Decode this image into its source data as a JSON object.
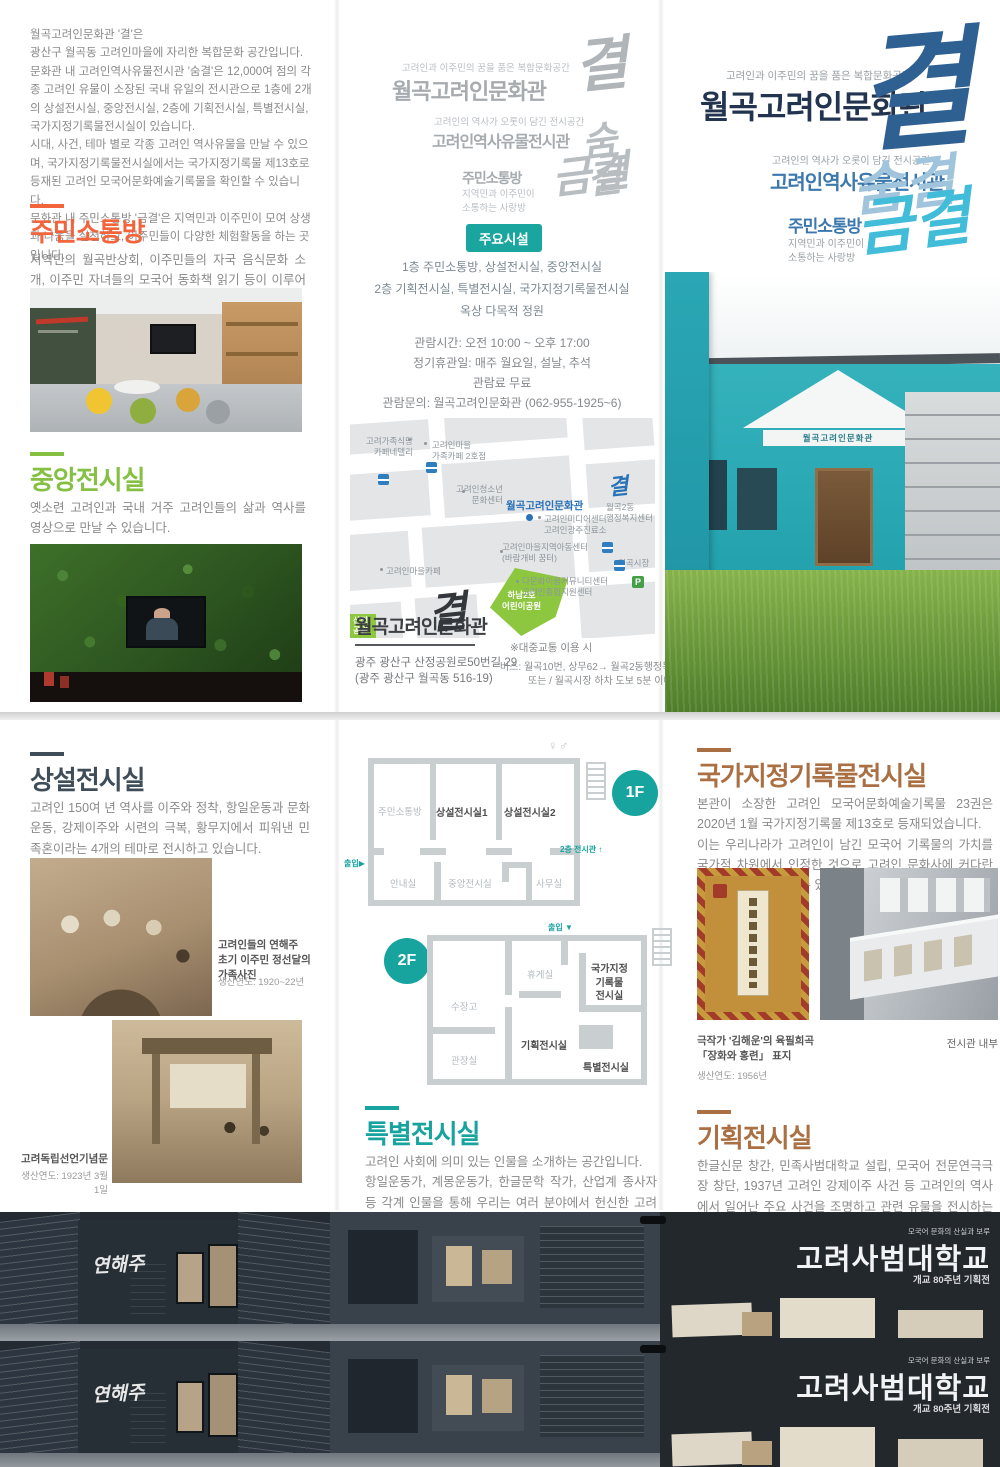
{
  "cover": {
    "tagline": "고려인과 이주민의 꿈을 품은 복합문화공간",
    "title": "월곡고려인문화관",
    "script_main": "결",
    "exhibit_tagline": "고려인의 역사가 오롯이 담긴 전시공간",
    "exhibit_title": "고려인역사유물전시관",
    "script_exhibit": "숨결",
    "lounge_title": "주민소통방",
    "script_lounge": "금결",
    "lounge_sub": "지역민과 이주민이\n소통하는 사랑방",
    "building_sign": "월곡고려인문화관"
  },
  "intro": {
    "text": "월곡고려인문화관 '결'은\n광산구 월곡동 고려인마을에 자리한 복합문화 공간입니다.\n문화관 내 고려인역사유물전시관 '숨결'은 12,000여 점의 각종 고려인 유물이 소장된 국내 유일의 전시관으로 1층에 2개의 상설전시실, 중앙전시실, 2층에 기획전시실, 특별전시실, 국가지정기록물전시실이 있습니다.\n시대, 사건, 테마 별로 각종 고려인 역사유물을 만날 수 있으며, 국가지정기록물전시실에서는 국가지정기록물 제13호로 등재된 고려인 모국어문화예술기록물을 확인할 수 있습니다.\n문화관 내 주민소통방 '금결'은 지역민과 이주민이 모여 상생과 나눔을 실천하고, 이주민들이 다양한 체험활동을 하는 곳 입니다."
  },
  "sections": {
    "communication": {
      "title": "주민소통방",
      "body": "지역민의 월곡반상회, 이주민들의 자국 음식문화 소개, 이주민 자녀들의 모국어 동화책 읽기 등이 이루어집니다."
    },
    "central": {
      "title": "중앙전시실",
      "body": "옛소련 고려인과 국내 거주 고려인들의 삶과 역사를 영상으로 만날 수 있습니다."
    },
    "permanent": {
      "title": "상설전시실",
      "body": "고려인 150여 년 역사를 이주와 정착, 항일운동과 문화운동, 강제이주와 시련의 극복, 황무지에서 피워낸 민족혼이라는 4개의 테마로 전시하고 있습니다."
    },
    "special": {
      "title": "특별전시실",
      "body": "고려인 사회에 의미 있는 인물을 소개하는 공간입니다.\n항일운동가, 계몽운동가, 한글문학 작가, 산업계 종사자 등 각계 인물을 통해 우리는 여러 분야에서 헌신한 고려인들의 숨결을 느낄 수 있습니다."
    },
    "records": {
      "title": "국가지정기록물전시실",
      "body": "본관이 소장한 고려인 모국어문화예술기록물 23권은 2020년 1월 국가지정기록물 제13호로 등재되었습니다.\n이는 우리나라가 고려인이 남긴 모국어 기록물의 가치를 국가적 차원에서 인정한 것으로 고려인 문화사에 커다란 의의를 지닌다고 할 수 있습니다."
    },
    "planning": {
      "title": "기획전시실",
      "body": "한글신문 창간, 민족사범대학교 설립, 모국어 전문연극극장 창단, 1937년 고려인 강제이주 사건 등 고려인의 역사에서 일어난 주요 사건을 조명하고 관련 유물을 전시하는 공간입니다."
    }
  },
  "facilities": {
    "badge": "주요시설",
    "floor1": "1층 주민소통방, 상설전시실, 중앙전시실",
    "floor2": "2층 기획전시실, 특별전시실, 국가지정기록물전시실",
    "roof": "옥상 다목적 정원"
  },
  "visit": {
    "hours": "관람시간: 오전 10:00 ~ 오후 17:00",
    "closed": "정기휴관일: 매주 월요일, 설날, 추석",
    "fee": "관람료 무료",
    "contact": "관람문의: 월곡고려인문화관 (062-955-1925~6)"
  },
  "location": {
    "name": "월곡고려인문화관",
    "script": "결",
    "road": "광주 광산구 산정공원로50번길 29",
    "lot": "(광주 광산구 월곡동 516-19)",
    "transit_note": "※대중교통 이용 시",
    "bus1": "버스: 월곡10번, 상무62→ 월곡2동행정복지센터",
    "bus2": "또는 / 월곡시장 하차 도보 5분 이내"
  },
  "map": {
    "main": {
      "label": "월곡고려인문화관",
      "script": "결"
    },
    "labels": [
      {
        "text": "고려가족식당\n카페네델리"
      },
      {
        "text": "고려인마을\n가족카페 2호점"
      },
      {
        "text": "고려인청소년\n문화센터"
      },
      {
        "text": "고려인미디어센터\n고려인광주진료소"
      },
      {
        "text": "월곡2동\n행정복지센터"
      },
      {
        "text": "고려인마을지역아동센터\n(바람개비 꿈터)"
      },
      {
        "text": "월곡시장"
      },
      {
        "text": "다문화이음커뮤니티센터\n고려인종합지원센터"
      },
      {
        "text": "고려인마을카페"
      }
    ],
    "parks": [
      {
        "name": "하남2호\n어린이공원"
      },
      {
        "name": "산정\n공원"
      }
    ],
    "parking": "P"
  },
  "floorplan": {
    "icons": {
      "restroom": "♀♂",
      "arrow_right": "▶",
      "arrow_up": "↑",
      "arrow_down": "▼"
    },
    "f1": {
      "badge": "1F",
      "rooms": [
        "주민소통방",
        "상설전시실1",
        "상설전시실2",
        "안내실",
        "중앙전시실",
        "사무실"
      ],
      "entry": "출입",
      "to_upper": "2층 전시관"
    },
    "f2": {
      "badge": "2F",
      "rooms": [
        "수장고",
        "휴게실",
        "국가지정\n기록물\n전시실",
        "관장실",
        "기획전시실",
        "특별전시실"
      ],
      "entry": "출입"
    }
  },
  "captions": {
    "family_title": "고려인들의 연해주\n초기 이주민 정선달의 가족사진",
    "family_year": "생산연도: 1920~22년",
    "gate_title": "고려독립선언기념문",
    "gate_year": "생산연도: 1923년 3월 1일",
    "manuscript_title": "극작가 '김해운'의 육필희곡\n「장화와 홍련」 표지",
    "manuscript_year": "생산연도: 1956년",
    "interior": "전시관 내부"
  },
  "strip": {
    "script": "연해주",
    "sign_small": "모국어 문화의 산실과 보루",
    "sign_title": "고려사범대학교",
    "sign_sub": "개교 80주년 기획전"
  },
  "colors": {
    "accent_orange": "#f2653c",
    "accent_green": "#85c043",
    "accent_teal": "#17a39e",
    "accent_brown": "#aa7044",
    "accent_navy": "#22344f",
    "accent_blue": "#3c78ad",
    "accent_cyan": "#41bcd9"
  }
}
